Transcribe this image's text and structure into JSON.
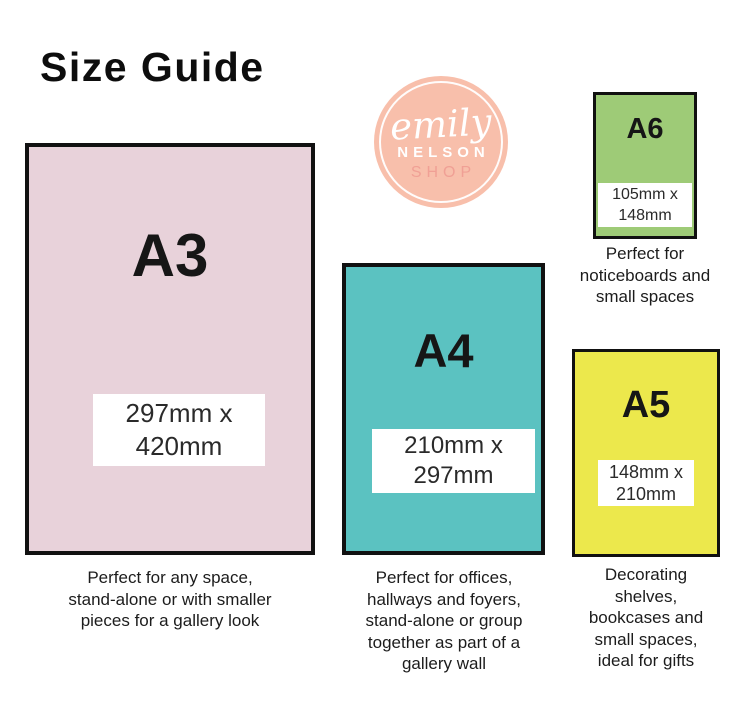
{
  "title": "Size Guide",
  "logo": {
    "script_text": "emily",
    "name_text": "NELSON",
    "shop_text": "SHOP",
    "circle_color": "#f8bfab",
    "shop_text_color": "#f0a095"
  },
  "colors": {
    "a3_fill": "#e8d2da",
    "a4_fill": "#5bc2c1",
    "a5_fill": "#ece84c",
    "a6_fill": "#9ecb77",
    "border": "#111111",
    "background": "#ffffff"
  },
  "cards": [
    {
      "id": "a3",
      "label": "A3",
      "dimensions": "297mm x\n420mm",
      "caption": "Perfect for any space,\nstand-alone or with smaller\npieces for a gallery look"
    },
    {
      "id": "a4",
      "label": "A4",
      "dimensions": "210mm x\n297mm",
      "caption": "Perfect for offices,\nhallways and foyers,\nstand-alone or group\ntogether as part of a\ngallery wall"
    },
    {
      "id": "a5",
      "label": "A5",
      "dimensions": "148mm x\n210mm",
      "caption": "Decorating\nshelves,\nbookcases and\nsmall spaces,\nideal for gifts"
    },
    {
      "id": "a6",
      "label": "A6",
      "dimensions": "105mm x\n148mm",
      "caption": "Perfect for\nnoticeboards and\nsmall spaces"
    }
  ]
}
